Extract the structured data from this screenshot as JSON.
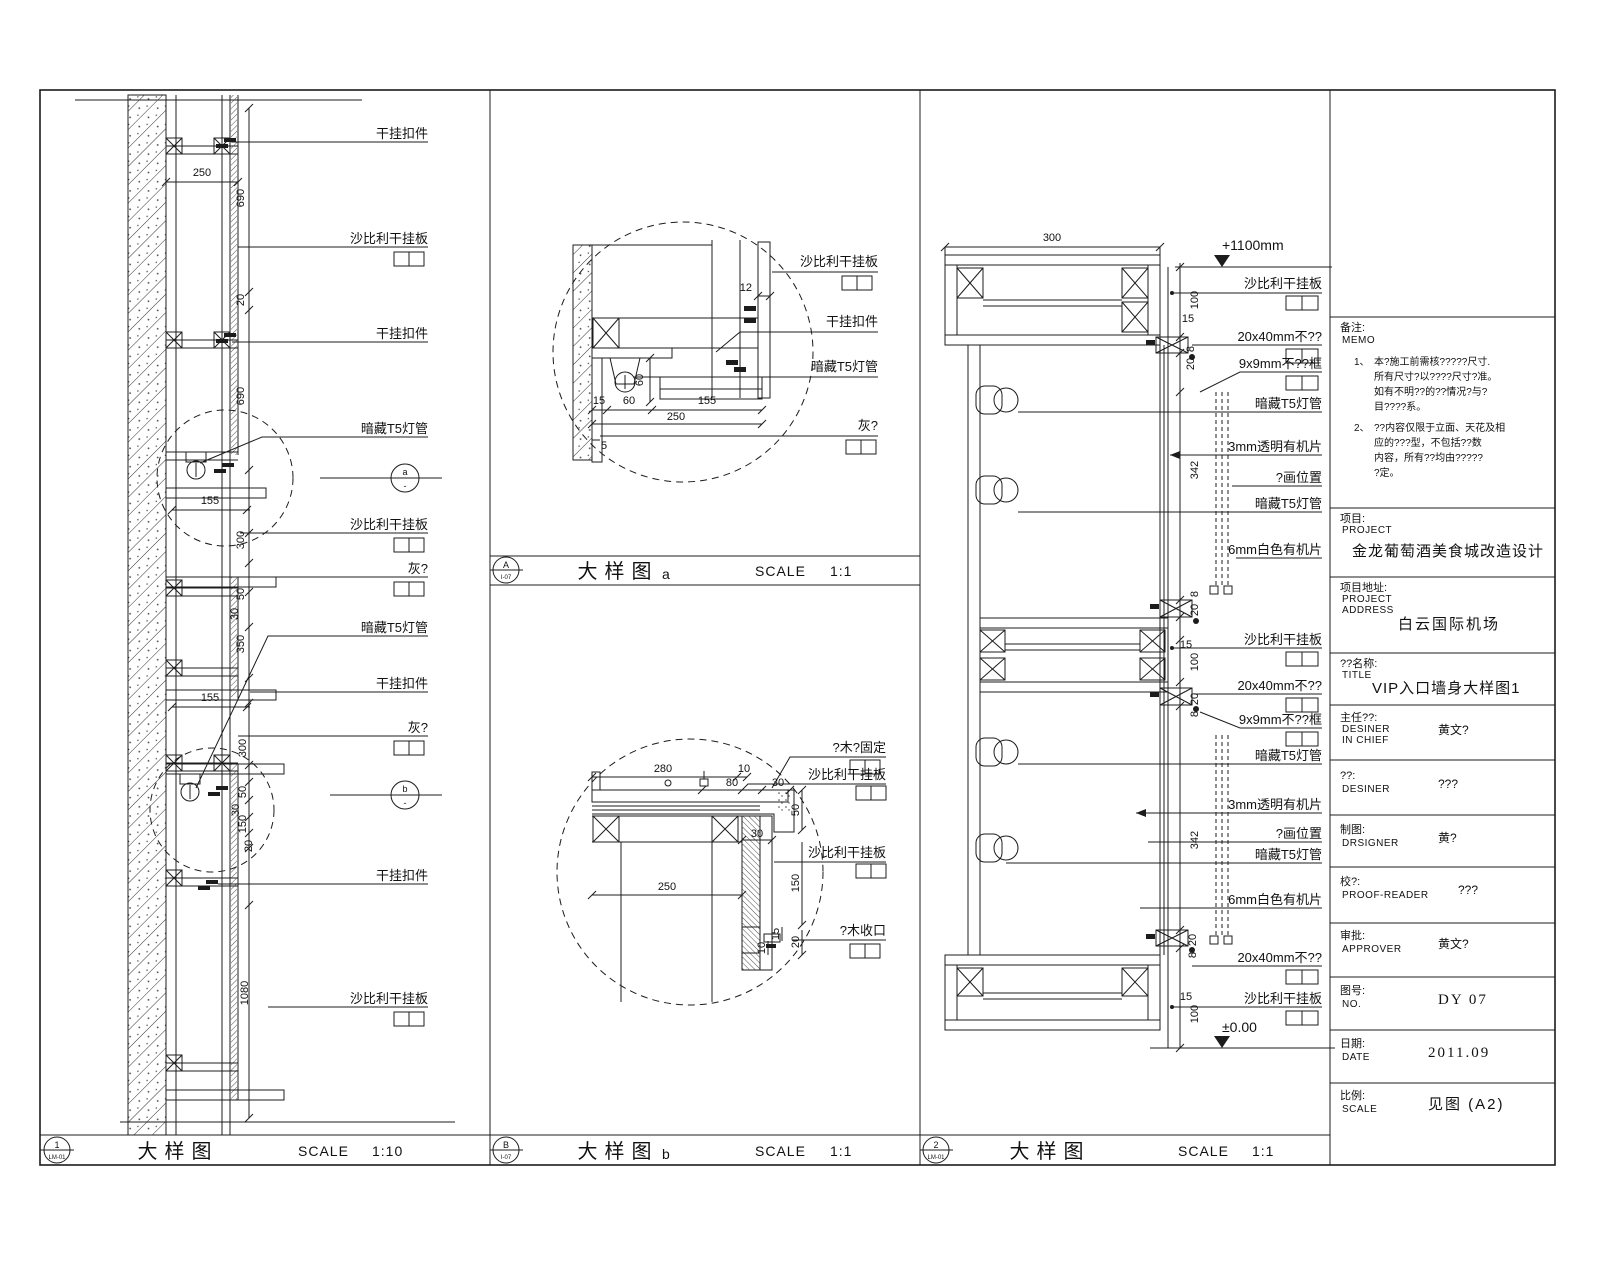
{
  "p1": {
    "footer": {
      "num": "1",
      "ref": "LM-01",
      "title": "大样图",
      "scale_label": "SCALE",
      "scale": "1:10"
    },
    "callout_a": "a",
    "callout_a_sub": "-",
    "callout_b": "b",
    "callout_b_sub": "-",
    "labels": [
      "干挂扣件",
      "沙比利干挂板",
      "干挂扣件",
      "暗藏T5灯管",
      "沙比利干挂板",
      "灰?",
      "暗藏T5灯管",
      "干挂扣件",
      "灰?",
      "干挂扣件",
      "沙比利干挂板"
    ],
    "dims": [
      "250",
      "690",
      "20",
      "690",
      "155",
      "300",
      "50",
      "30",
      "350",
      "155",
      "300",
      "50",
      "30",
      "150",
      "20",
      "1080"
    ]
  },
  "p2a": {
    "footer": {
      "num": "A",
      "ref": "I-07",
      "title": "大样图",
      "suffix": "a",
      "scale_label": "SCALE",
      "scale": "1:1"
    },
    "labels": [
      "沙比利干挂板",
      "干挂扣件",
      "暗藏T5灯管",
      "灰?"
    ],
    "dims": [
      "12",
      "60",
      "15",
      "60",
      "155",
      "250",
      "5"
    ]
  },
  "p2b": {
    "footer": {
      "num": "B",
      "ref": "I-07",
      "title": "大样图",
      "suffix": "b",
      "scale_label": "SCALE",
      "scale": "1:1"
    },
    "labels": [
      "?木?固定",
      "沙比利干挂板",
      "沙比利干挂板",
      "?木收口"
    ],
    "dims": [
      "280",
      "10",
      "80",
      "30",
      "50",
      "30",
      "250",
      "150",
      "15",
      "10",
      "20"
    ]
  },
  "p3": {
    "footer": {
      "num": "2",
      "ref": "LM-01",
      "title": "大样图",
      "scale_label": "SCALE",
      "scale": "1:1"
    },
    "levels": {
      "top": "+1100mm",
      "bottom": "±0.00"
    },
    "top_dim": "300",
    "labels": [
      "沙比利干挂板",
      "20x40mm不??",
      "9x9mm不??框",
      "暗藏T5灯管",
      "3mm透明有机片",
      "?画位置",
      "暗藏T5灯管",
      "6mm白色有机片",
      "沙比利干挂板",
      "20x40mm不??",
      "9x9mm不??框",
      "暗藏T5灯管",
      "3mm透明有机片",
      "?画位置",
      "暗藏T5灯管",
      "6mm白色有机片",
      "20x40mm不??",
      "沙比利干挂板"
    ],
    "dims": [
      "100",
      "15",
      "8",
      "20",
      "342",
      "8",
      "20",
      "15",
      "100",
      "20",
      "8",
      "342",
      "20",
      "8",
      "15",
      "100"
    ]
  },
  "tb": {
    "memo": {
      "label": "备注:",
      "en": "MEMO",
      "item1_no": "1、",
      "item1_lines": [
        "本?施工前需核?????尺寸.",
        "所有尺寸?以????尺寸?准。",
        "如有不明??的??情况?与?",
        "目????系。"
      ],
      "item2_no": "2、",
      "item2_lines": [
        "??内容仅限于立面、天花及相",
        "应的???型，不包括??数",
        "内容，所有??均由?????",
        "?定。"
      ]
    },
    "project": {
      "label": "项目:",
      "en": "PROJECT",
      "value": "金龙葡萄酒美食城改造设计"
    },
    "address": {
      "label": "项目地址:",
      "en": "PROJECT",
      "en2": "ADDRESS",
      "value": "白云国际机场"
    },
    "title": {
      "label": "??名称:",
      "en": "TITLE",
      "value": "VIP入口墙身大样图1"
    },
    "rows": [
      {
        "label": "主任??:",
        "en": "DESINER",
        "en2": "IN CHIEF",
        "value": "黄文?"
      },
      {
        "label": "??:",
        "en": "DESINER",
        "en2": "",
        "value": "???"
      },
      {
        "label": "制图:",
        "en": "DRSIGNER",
        "en2": "",
        "value": "黄?"
      },
      {
        "label": "校?:",
        "en": "PROOF-READER",
        "en2": "",
        "value": "???"
      },
      {
        "label": "审批:",
        "en": "APPROVER",
        "en2": "",
        "value": "黄文?"
      },
      {
        "label": "图号:",
        "en": "NO.",
        "en2": "",
        "value": "DY 07"
      },
      {
        "label": "日期:",
        "en": "DATE",
        "en2": "",
        "value": "2011.09"
      },
      {
        "label": "比例:",
        "en": "SCALE",
        "en2": "",
        "value": "见图 (A2)"
      }
    ]
  }
}
